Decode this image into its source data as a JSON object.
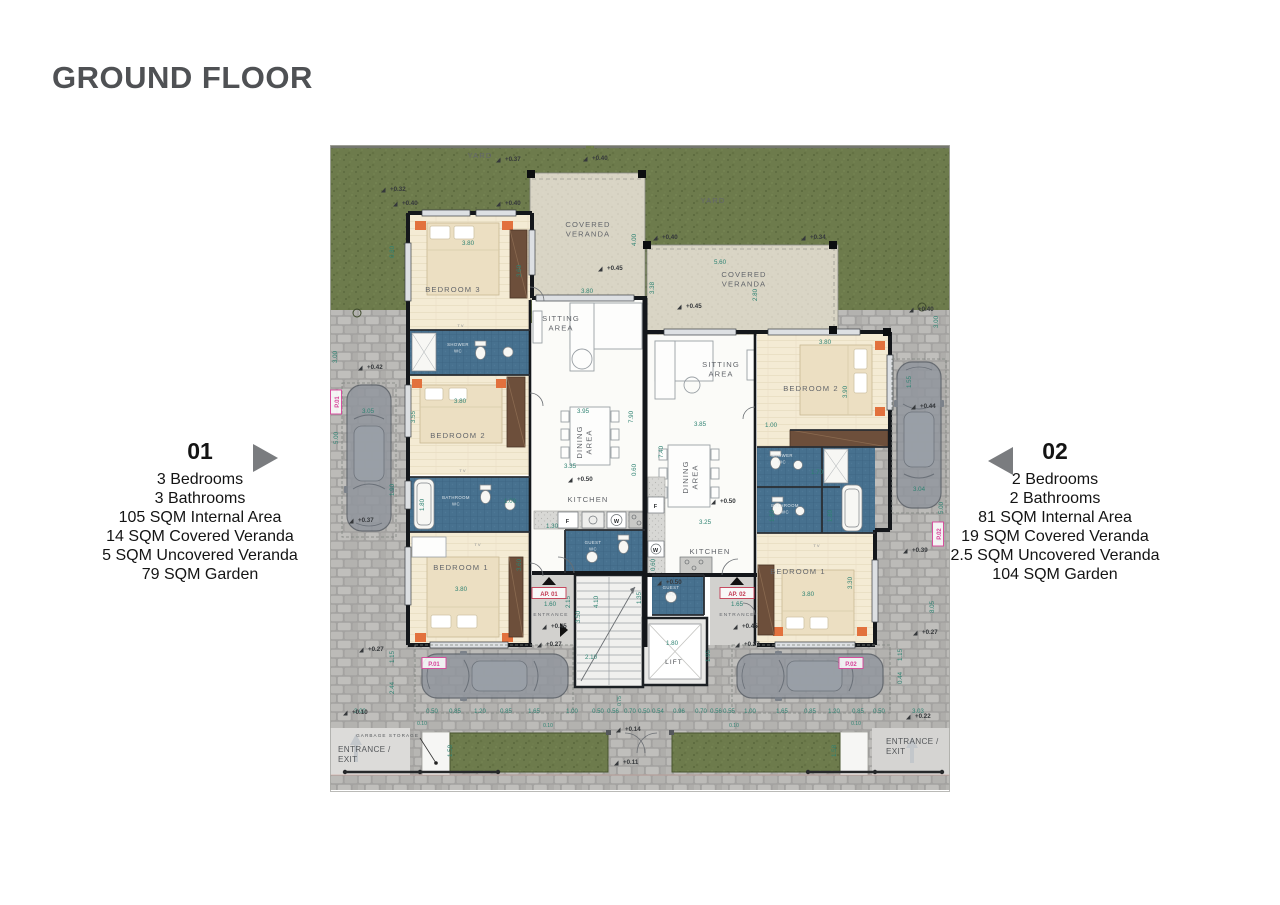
{
  "title": "GROUND FLOOR",
  "apartments": {
    "a01": {
      "number": "01",
      "specs": [
        "3 Bedrooms",
        "3 Bathrooms",
        "105 SQM Internal Area",
        "14 SQM Covered Veranda",
        "5 SQM Uncovered Veranda",
        "79 SQM Garden"
      ]
    },
    "a02": {
      "number": "02",
      "specs": [
        "2 Bedrooms",
        "2 Bathrooms",
        "81 SQM Internal Area",
        "19 SQM Covered Veranda",
        "2.5 SQM Uncovered Veranda",
        "104 SQM Garden"
      ]
    }
  },
  "colors": {
    "title_gray": "#4f5154",
    "arrow_gray": "#7a7c7f",
    "grass": "#6d7b4c",
    "paving": "#a9a8a6",
    "veranda_stone": "#d9d5c5",
    "wood_floor": "#f4ebd4",
    "bath_tile": "#47718f",
    "wall": "#14171b",
    "dim_teal": "#2e8272",
    "level_dark": "#35383b",
    "parking_pink": "#d8439a",
    "ap_red": "#c23a52"
  },
  "plan": {
    "room_labels": [
      {
        "t": "YARD",
        "x": 150,
        "y": 13,
        "n": "yard-label"
      },
      {
        "t": "YARD",
        "x": 383,
        "y": 58,
        "n": "yard-label"
      },
      {
        "lines": [
          "COVERED",
          "VERANDA"
        ],
        "x": 258,
        "y": 82,
        "n": "covered-veranda-01-label"
      },
      {
        "lines": [
          "COVERED",
          "VERANDA"
        ],
        "x": 414,
        "y": 132,
        "n": "covered-veranda-02-label"
      },
      {
        "lines": [
          "SITTING",
          "AREA"
        ],
        "x": 231,
        "y": 176,
        "n": "sitting-area-01-label"
      },
      {
        "lines": [
          "SITTING",
          "AREA"
        ],
        "x": 391,
        "y": 222,
        "n": "sitting-area-02-label"
      },
      {
        "t": "BEDROOM 3",
        "x": 123,
        "y": 147,
        "n": "bedroom3-01-label"
      },
      {
        "t": "BEDROOM 2",
        "x": 128,
        "y": 293,
        "n": "bedroom2-01-label"
      },
      {
        "t": "BEDROOM 1",
        "x": 131,
        "y": 425,
        "n": "bedroom1-01-label"
      },
      {
        "t": "BEDROOM 2",
        "x": 481,
        "y": 246,
        "n": "bedroom2-02-label"
      },
      {
        "t": "BEDROOM 1",
        "x": 468,
        "y": 429,
        "n": "bedroom1-02-label"
      },
      {
        "lines": [
          "DINING",
          "AREA"
        ],
        "x": 252,
        "y": 297,
        "r": -90,
        "n": "dining-area-01-label"
      },
      {
        "lines": [
          "DINING",
          "AREA"
        ],
        "x": 358,
        "y": 332,
        "r": -90,
        "n": "dining-area-02-label"
      },
      {
        "t": "KITCHEN",
        "x": 258,
        "y": 357,
        "n": "kitchen-01-label"
      },
      {
        "t": "KITCHEN",
        "x": 380,
        "y": 409,
        "n": "kitchen-02-label"
      },
      {
        "t": "LIFT",
        "x": 344,
        "y": 519,
        "s": 6.5,
        "c": "#45484c",
        "n": "lift-label"
      },
      {
        "t": "ENTRANCE",
        "x": 221,
        "y": 471,
        "s": 4.8,
        "n": "entrance-01-label"
      },
      {
        "t": "ENTRANCE",
        "x": 407,
        "y": 471,
        "s": 4.8,
        "n": "entrance-02-label"
      },
      {
        "t": "GARBAGE STORAGE",
        "x": 89,
        "y": 592,
        "s": 4.6,
        "a": "end",
        "c": "#54575a",
        "n": "garbage-storage-label"
      },
      {
        "lines": [
          "ENTRANCE /",
          "EXIT"
        ],
        "x": 8,
        "y": 607,
        "s": 8.2,
        "a": "start",
        "c": "#54575a",
        "ls": 0.3,
        "n": "entrance-exit-left-label"
      },
      {
        "lines": [
          "ENTRANCE /",
          "EXIT"
        ],
        "x": 556,
        "y": 599,
        "s": 8.2,
        "a": "start",
        "c": "#54575a",
        "ls": 0.3,
        "n": "entrance-exit-right-label"
      },
      {
        "t": "TV",
        "x": 131,
        "y": 182,
        "s": 4,
        "c": "#888b8e",
        "n": "tv-label"
      },
      {
        "t": "TV",
        "x": 133,
        "y": 327,
        "s": 4,
        "c": "#888b8e",
        "n": "tv-label"
      },
      {
        "t": "TV",
        "x": 148,
        "y": 401,
        "s": 4,
        "c": "#888b8e",
        "n": "tv-label"
      },
      {
        "t": "TV",
        "x": 487,
        "y": 402,
        "s": 4,
        "c": "#888b8e",
        "n": "tv-label"
      },
      {
        "t": "F",
        "x": 238,
        "y": 378,
        "s": 5.5,
        "c": "#26292c",
        "w": "700",
        "n": "fridge-label"
      },
      {
        "t": "W",
        "x": 287,
        "y": 378,
        "s": 5.5,
        "c": "#26292c",
        "w": "700",
        "n": "washer-label"
      },
      {
        "t": "F",
        "x": 326,
        "y": 363,
        "s": 5.5,
        "c": "#26292c",
        "w": "700",
        "n": "fridge-label"
      },
      {
        "t": "W",
        "x": 326,
        "y": 407,
        "s": 5.5,
        "c": "#26292c",
        "w": "700",
        "n": "washer-label"
      }
    ],
    "small_labels": [
      {
        "lines": [
          "SHOWER",
          "WC"
        ],
        "x": 128,
        "y": 201
      },
      {
        "lines": [
          "BATHROOM",
          "WC"
        ],
        "x": 126,
        "y": 354
      },
      {
        "lines": [
          "GUEST",
          "WC"
        ],
        "x": 263,
        "y": 399
      },
      {
        "lines": [
          "SHOWER",
          "WC"
        ],
        "x": 452,
        "y": 312
      },
      {
        "lines": [
          "BATHROOM",
          "WC"
        ],
        "x": 455,
        "y": 362
      },
      {
        "lines": [
          "GUEST",
          "WC"
        ],
        "x": 341,
        "y": 444
      }
    ],
    "misc_labels": [
      {
        "t": "AP. 01",
        "x": 219,
        "y": 451,
        "box": "red",
        "n": "ap-01-tag"
      },
      {
        "t": "AP. 02",
        "x": 407,
        "y": 451,
        "box": "red",
        "n": "ap-02-tag"
      },
      {
        "t": "P.01",
        "x": 104,
        "y": 521,
        "box": "pink",
        "n": "parking-01-tag"
      },
      {
        "t": "P.02",
        "x": 521,
        "y": 521,
        "box": "pink",
        "n": "parking-02-tag"
      },
      {
        "t": "P.01",
        "x": 9,
        "y": 257,
        "r": -90,
        "box": "pink",
        "n": "parking-01-tag"
      },
      {
        "t": "P.02",
        "x": 611,
        "y": 389,
        "r": -90,
        "box": "pink",
        "n": "parking-02-tag"
      }
    ],
    "dims": [
      {
        "t": "3.80",
        "x": 138,
        "y": 100
      },
      {
        "t": "3.60",
        "x": 191,
        "y": 126,
        "r": -90
      },
      {
        "t": "0.80",
        "x": 64,
        "y": 107,
        "r": -90
      },
      {
        "t": "1.00",
        "x": 180,
        "y": 358
      },
      {
        "t": "3.80",
        "x": 257,
        "y": 148
      },
      {
        "t": "4.00",
        "x": 306,
        "y": 95,
        "r": -90
      },
      {
        "t": "5.60",
        "x": 390,
        "y": 119
      },
      {
        "t": "2.80",
        "x": 427,
        "y": 150,
        "r": -90
      },
      {
        "t": "3.38",
        "x": 324,
        "y": 143,
        "r": -90
      },
      {
        "t": "3.80",
        "x": 130,
        "y": 258
      },
      {
        "t": "3.55",
        "x": 85,
        "y": 272,
        "r": -90
      },
      {
        "t": "1.80",
        "x": 94,
        "y": 360,
        "r": -90
      },
      {
        "t": "3.80",
        "x": 131,
        "y": 446
      },
      {
        "t": "3.60",
        "x": 191,
        "y": 420,
        "r": -90
      },
      {
        "t": "3.95",
        "x": 253,
        "y": 268
      },
      {
        "t": "7.90",
        "x": 303,
        "y": 272,
        "r": -90
      },
      {
        "t": "3.35",
        "x": 240,
        "y": 323
      },
      {
        "t": "0.60",
        "x": 306,
        "y": 325,
        "r": -90
      },
      {
        "t": "1.30",
        "x": 222,
        "y": 383
      },
      {
        "t": "3.85",
        "x": 370,
        "y": 281
      },
      {
        "t": "7.40",
        "x": 333,
        "y": 307,
        "r": -90
      },
      {
        "t": "3.25",
        "x": 375,
        "y": 379
      },
      {
        "t": "0.60",
        "x": 325,
        "y": 420,
        "r": -90
      },
      {
        "t": "3.80",
        "x": 495,
        "y": 199
      },
      {
        "t": "3.90",
        "x": 517,
        "y": 247,
        "r": -90
      },
      {
        "t": "1.00",
        "x": 441,
        "y": 282
      },
      {
        "t": "1.70",
        "x": 487,
        "y": 329
      },
      {
        "t": "1.80",
        "x": 502,
        "y": 371,
        "r": -90
      },
      {
        "t": "1.80",
        "x": 444,
        "y": 371,
        "r": -90
      },
      {
        "t": "3.80",
        "x": 478,
        "y": 451
      },
      {
        "t": "3.30",
        "x": 522,
        "y": 438,
        "r": -90
      },
      {
        "t": "1.80",
        "x": 342,
        "y": 500
      },
      {
        "t": "1.95",
        "x": 380,
        "y": 511,
        "r": -90
      },
      {
        "t": "2.10",
        "x": 261,
        "y": 514
      },
      {
        "t": "3.50",
        "x": 250,
        "y": 472,
        "r": -90
      },
      {
        "t": "4.10",
        "x": 268,
        "y": 457,
        "r": -90
      },
      {
        "t": "1.35",
        "x": 311,
        "y": 453,
        "r": -90
      },
      {
        "t": "1.60",
        "x": 220,
        "y": 461
      },
      {
        "t": "1.65",
        "x": 407,
        "y": 461
      },
      {
        "t": "2.15",
        "x": 240,
        "y": 457,
        "r": -90
      },
      {
        "t": "3.05",
        "x": 38,
        "y": 268
      },
      {
        "t": "5.00",
        "x": 8,
        "y": 293,
        "r": -90
      },
      {
        "t": "3.00",
        "x": 7,
        "y": 212,
        "r": -90
      },
      {
        "t": "1.90",
        "x": 64,
        "y": 345,
        "r": -90
      },
      {
        "t": "3.04",
        "x": 589,
        "y": 346
      },
      {
        "t": "5.00",
        "x": 613,
        "y": 363,
        "r": -90
      },
      {
        "t": "1.55",
        "x": 581,
        "y": 237,
        "r": -90
      },
      {
        "t": "3.00",
        "x": 608,
        "y": 177,
        "r": -90
      },
      {
        "t": "8.05",
        "x": 604,
        "y": 462,
        "r": -90
      },
      {
        "t": "1.15",
        "x": 572,
        "y": 510,
        "r": -90
      },
      {
        "t": "0.44",
        "x": 572,
        "y": 533,
        "r": -90
      },
      {
        "t": "1.15",
        "x": 64,
        "y": 512,
        "r": -90
      },
      {
        "t": "2.44",
        "x": 64,
        "y": 543,
        "r": -90
      },
      {
        "t": "1.58",
        "x": 122,
        "y": 606,
        "r": -90
      },
      {
        "t": "1.58",
        "x": 506,
        "y": 606,
        "r": -90
      },
      {
        "t": "0.10",
        "x": 92,
        "y": 580,
        "s": 5
      },
      {
        "t": "0.10",
        "x": 218,
        "y": 582,
        "s": 5
      },
      {
        "t": "0.10",
        "x": 404,
        "y": 582,
        "s": 5
      },
      {
        "t": "0.10",
        "x": 526,
        "y": 580,
        "s": 5
      },
      {
        "t": "0.75",
        "x": 291,
        "y": 556,
        "r": -90,
        "s": 5
      }
    ],
    "chains": [
      {
        "y": 568,
        "items": [
          {
            "t": "3.00",
            "x": 30
          },
          {
            "t": "0.50",
            "x": 102
          },
          {
            "t": "0.85",
            "x": 125
          },
          {
            "t": "1.20",
            "x": 150
          },
          {
            "t": "0.85",
            "x": 176
          },
          {
            "t": "1.65",
            "x": 204
          },
          {
            "t": "1.00",
            "x": 242
          },
          {
            "t": "0.50",
            "x": 268
          },
          {
            "t": "0.56",
            "x": 283
          },
          {
            "t": "0.70",
            "x": 300
          },
          {
            "t": "0.50",
            "x": 314
          },
          {
            "t": "0.54",
            "x": 328
          },
          {
            "t": "0.96",
            "x": 349
          },
          {
            "t": "0.70",
            "x": 371
          },
          {
            "t": "0.56",
            "x": 386
          },
          {
            "t": "0.55",
            "x": 399
          },
          {
            "t": "1.00",
            "x": 420
          },
          {
            "t": "1.65",
            "x": 452
          },
          {
            "t": "0.85",
            "x": 480
          },
          {
            "t": "1.20",
            "x": 504
          },
          {
            "t": "0.85",
            "x": 528
          },
          {
            "t": "0.50",
            "x": 549
          },
          {
            "t": "3.03",
            "x": 588
          }
        ]
      }
    ],
    "levels": [
      {
        "t": "+0.37",
        "x": 175,
        "y": 16
      },
      {
        "t": "+0.40",
        "x": 262,
        "y": 15
      },
      {
        "t": "+0.32",
        "x": 60,
        "y": 46
      },
      {
        "t": "+0.40",
        "x": 72,
        "y": 60
      },
      {
        "t": "+0.40",
        "x": 175,
        "y": 60
      },
      {
        "t": "+0.34",
        "x": 480,
        "y": 94
      },
      {
        "t": "+0.40",
        "x": 332,
        "y": 94
      },
      {
        "t": "+0.40",
        "x": 588,
        "y": 166
      },
      {
        "t": "+0.45",
        "x": 277,
        "y": 125
      },
      {
        "t": "+0.45",
        "x": 356,
        "y": 163
      },
      {
        "t": "+0.42",
        "x": 37,
        "y": 224
      },
      {
        "t": "+0.37",
        "x": 28,
        "y": 377
      },
      {
        "t": "+0.44",
        "x": 590,
        "y": 263
      },
      {
        "t": "+0.39",
        "x": 582,
        "y": 407
      },
      {
        "t": "+0.50",
        "x": 247,
        "y": 336
      },
      {
        "t": "+0.50",
        "x": 390,
        "y": 358
      },
      {
        "t": "+0.50",
        "x": 336,
        "y": 439
      },
      {
        "t": "+0.45",
        "x": 221,
        "y": 483
      },
      {
        "t": "+0.45",
        "x": 412,
        "y": 483
      },
      {
        "t": "+0.27",
        "x": 216,
        "y": 501
      },
      {
        "t": "+0.27",
        "x": 414,
        "y": 501
      },
      {
        "t": "+0.27",
        "x": 38,
        "y": 506
      },
      {
        "t": "+0.27",
        "x": 592,
        "y": 489
      },
      {
        "t": "+0.10",
        "x": 22,
        "y": 569
      },
      {
        "t": "+0.22",
        "x": 585,
        "y": 573
      },
      {
        "t": "+0.14",
        "x": 295,
        "y": 586
      },
      {
        "t": "+0.11",
        "x": 293,
        "y": 619
      }
    ]
  }
}
